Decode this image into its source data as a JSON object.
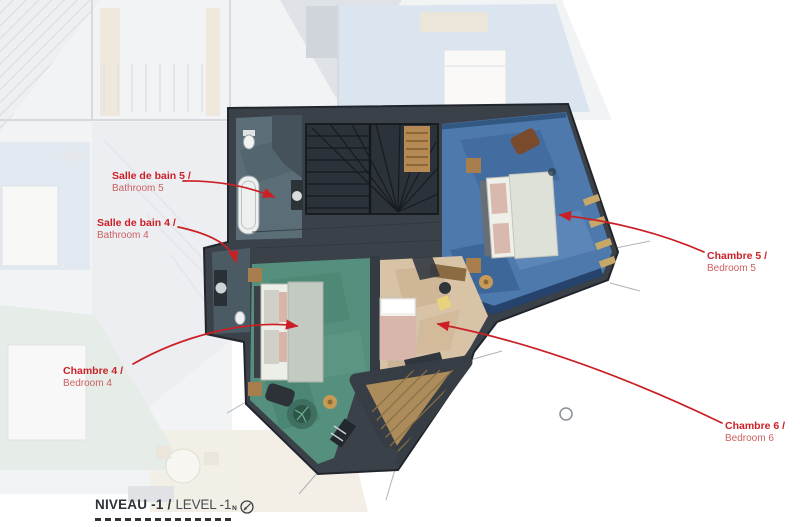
{
  "plan": {
    "rooms": {
      "bathroom5": {
        "fr": "Salle de bain 5 /",
        "en": "Bathroom 5"
      },
      "bathroom4": {
        "fr": "Salle de bain 4 /",
        "en": "Bathroom 4"
      },
      "bedroom4": {
        "fr": "Chambre 4 /",
        "en": "Bedroom 4"
      },
      "bedroom5": {
        "fr": "Chambre 5 /",
        "en": "Bedroom 5"
      },
      "bedroom6": {
        "fr": "Chambre 6 /",
        "en": "Bedroom 6"
      }
    },
    "footer": {
      "fr": "NIVEAU -1 /",
      "en": "LEVEL -1",
      "compass_letter": "N"
    }
  },
  "colors": {
    "accent_red": "#cb1f26",
    "accent_red_soft": "#cd5f60",
    "wall_dark": "#3a4149",
    "bedroom5_blue": "#4d79ad",
    "bedroom4_green": "#55907e",
    "bedroom6_beige": "#d8c3a6",
    "bathroom_slate": "#5b6e78",
    "terrace_wood": "#ab8c5a",
    "title_dark": "#2e3338"
  }
}
